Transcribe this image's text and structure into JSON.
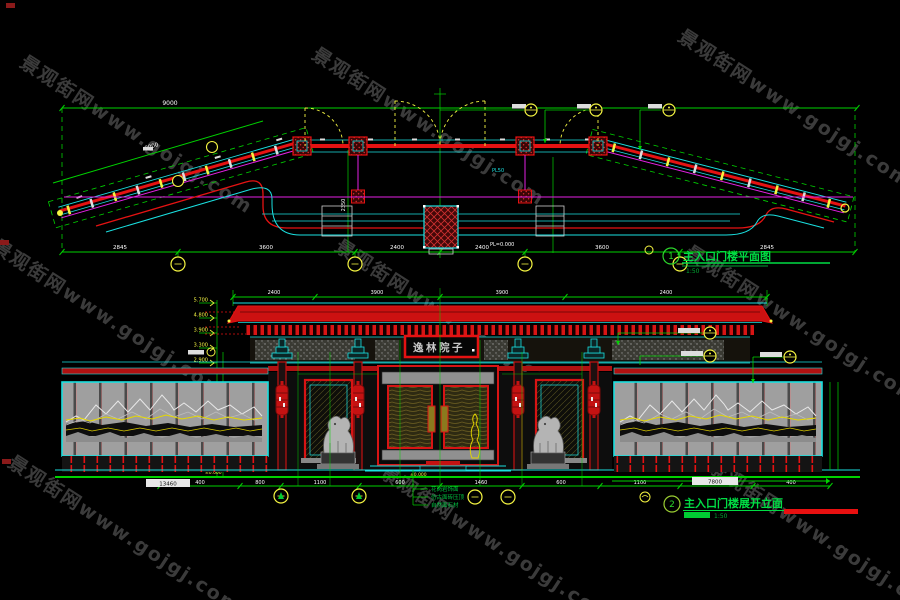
{
  "watermark": {
    "text": "景观街网www.gojgj.com"
  },
  "titles": {
    "plan": {
      "number": "1",
      "label": "主入口门楼平面图",
      "scale": "1:50"
    },
    "elevation": {
      "number": "2",
      "label": "主入口门楼展开立面",
      "scale": "1:50"
    }
  },
  "signboard": {
    "text": "逸林院子"
  },
  "plan": {
    "total_width_label": "9000",
    "wing_dim": "8000",
    "beam_label_1": "PL50",
    "beam_label_2": "PL=0.000",
    "vertical_dim": "2350",
    "bottom_dims": [
      "2845",
      "3600",
      "2400",
      "2400",
      "3600",
      "2845"
    ]
  },
  "elevation": {
    "roof_dims": [
      "2400",
      "3900",
      "3900",
      "2400"
    ],
    "level_labels": [
      "5.700",
      "4.800",
      "3.900",
      "3.300",
      "2.900"
    ],
    "ground_level": "±0.000",
    "bottom_dims": [
      "400",
      "800",
      "1100",
      "600",
      "1460",
      "600",
      "1100",
      "800",
      "400"
    ],
    "total_left": "13460",
    "total_right": "7800",
    "materials": [
      "花岗岩饰面",
      "仿古面砖压顶",
      "自然面石材"
    ]
  },
  "colors": {
    "line_green": "#00d200",
    "line_cyan": "#1ae0e0",
    "line_red": "#e51212",
    "line_magenta": "#e520e5",
    "line_yellow": "#f5f542"
  }
}
